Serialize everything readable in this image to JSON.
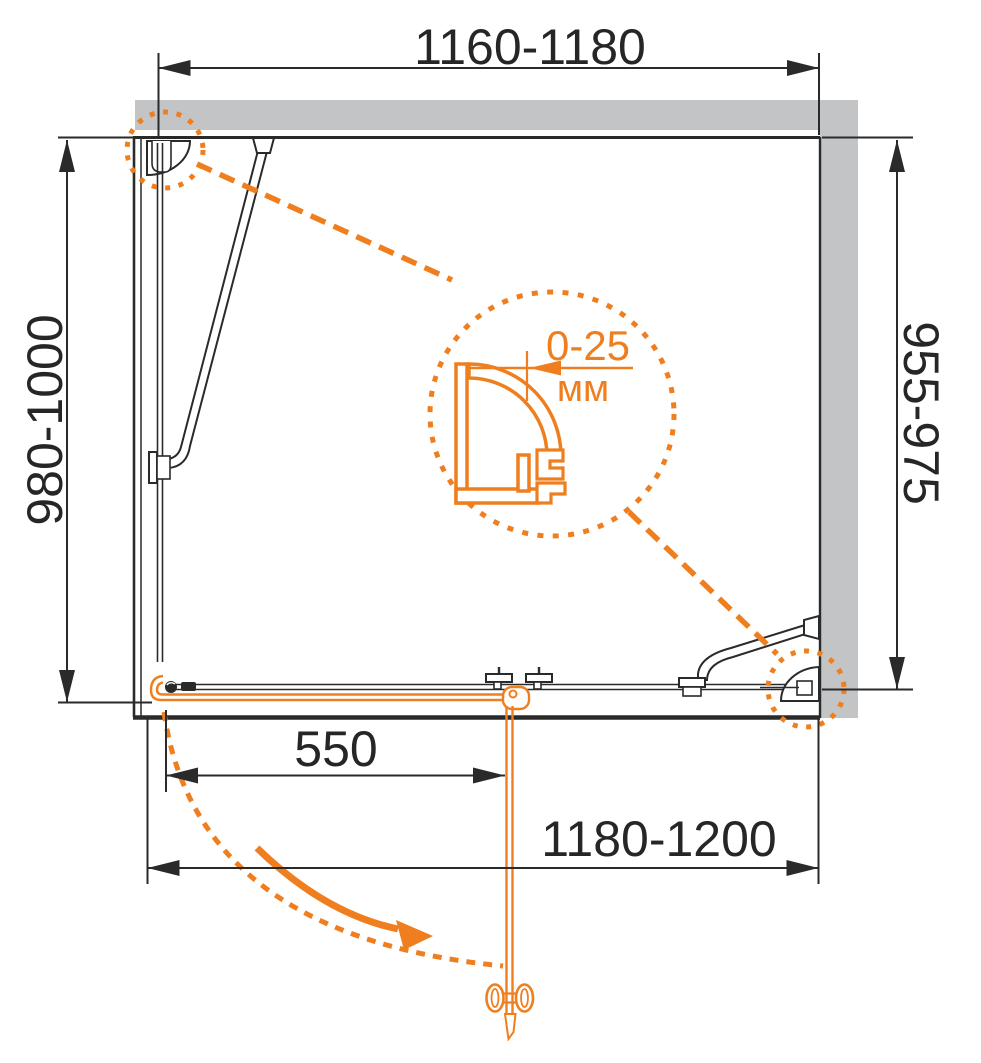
{
  "drawing": {
    "title": "shower-enclosure-plan-drawing",
    "dimensions": {
      "top_width_mm": "1160-1180",
      "left_depth_mm": "980-1000",
      "right_depth_mm": "955-975",
      "door_width_mm": "550",
      "bottom_width_mm": "1180-1200"
    },
    "detail": {
      "adjustment_range": "0-25",
      "unit": "мм"
    },
    "colors": {
      "accent_orange": "#EF7F1E",
      "line_black": "#2A2A2A",
      "wall_gray": "#C3C4C6"
    }
  }
}
